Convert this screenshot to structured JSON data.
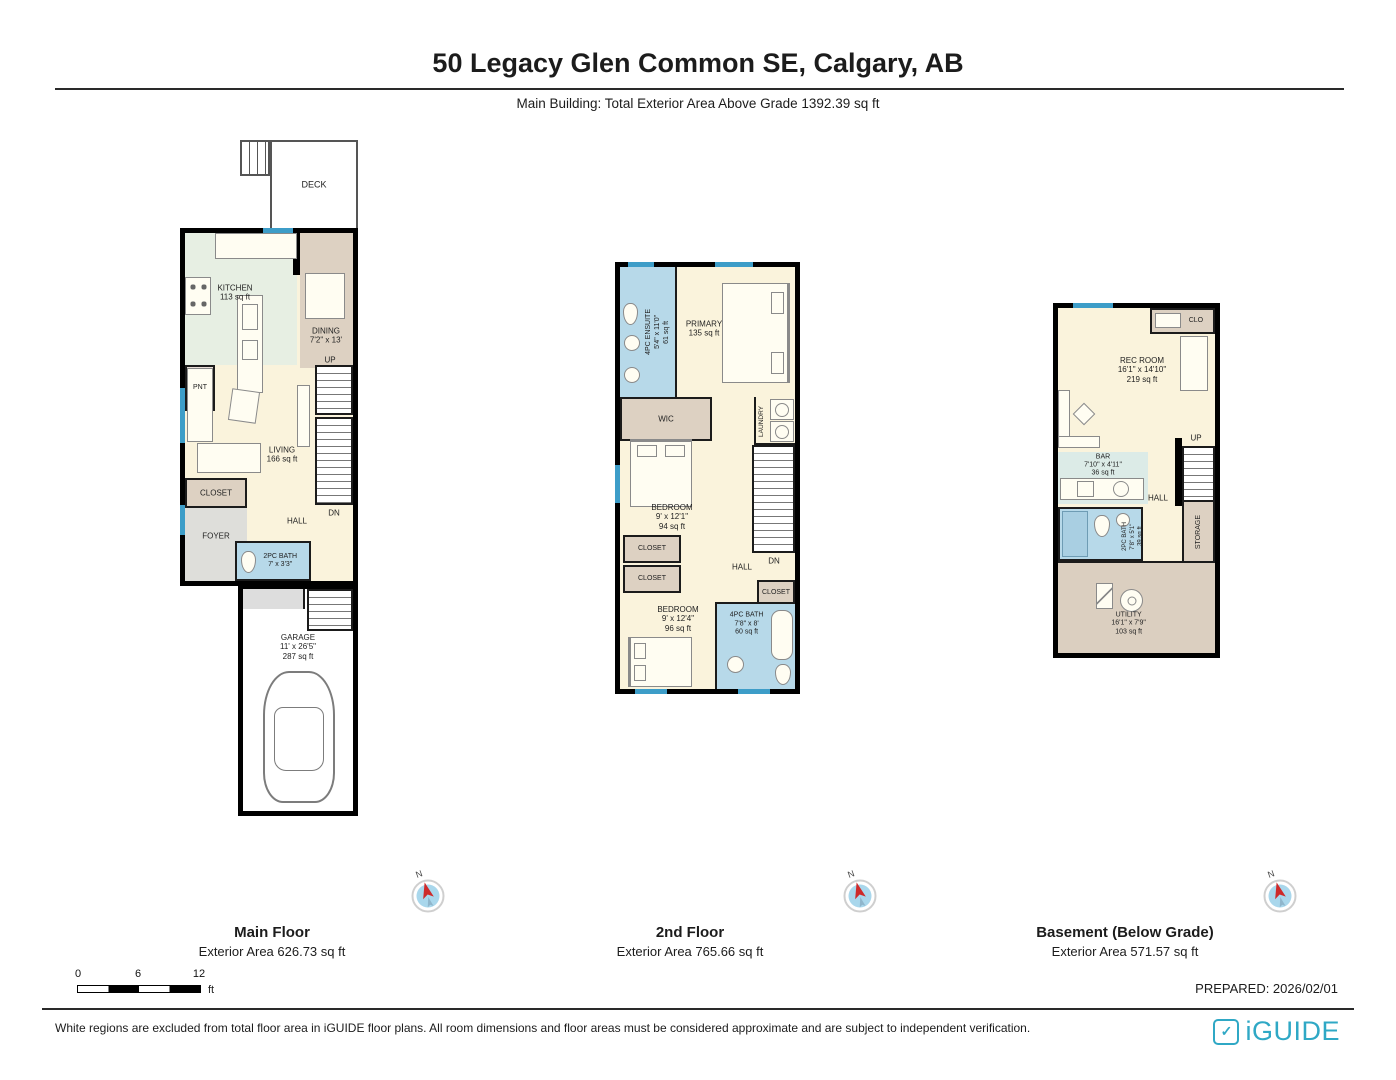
{
  "title": "50 Legacy Glen Common SE, Calgary, AB",
  "subtitle": "Main Building: Total Exterior Area Above Grade 1392.39 sq ft",
  "compass": {
    "n": "N"
  },
  "colors": {
    "brand_teal": "#2FA8C5",
    "window_blue": "#3D9DC8",
    "bath_blue": "#B7D9E9",
    "room_cream": "#FAF3DC",
    "room_tan": "#DBCFC0",
    "kitchen_green": "#E7EFE3",
    "compass_red": "#CE2A2A"
  },
  "floors": {
    "main": {
      "name": "Main Floor",
      "area": "Exterior Area 626.73 sq ft",
      "rooms": {
        "deck": {
          "label": "DECK"
        },
        "kitchen": {
          "label": "KITCHEN",
          "area": "113 sq ft"
        },
        "pantry": {
          "label": "PNT"
        },
        "dining": {
          "label": "DINING",
          "dims": "7'2\" x 13'"
        },
        "up": {
          "label": "UP"
        },
        "dn": {
          "label": "DN"
        },
        "living": {
          "label": "LIVING",
          "area": "166 sq ft"
        },
        "closet": {
          "label": "CLOSET"
        },
        "foyer": {
          "label": "FOYER"
        },
        "hall": {
          "label": "HALL"
        },
        "bath": {
          "label": "2PC BATH",
          "dims": "7' x 3'3\""
        },
        "garage": {
          "label": "GARAGE",
          "dims": "11' x 26'5\"",
          "area": "287 sq ft"
        }
      }
    },
    "second": {
      "name": "2nd Floor",
      "area": "Exterior Area 765.66 sq ft",
      "rooms": {
        "ensuite": {
          "label": "4PC ENSUITE",
          "dims": "5'4\" x 11'0\"",
          "area": "61 sq ft"
        },
        "primary": {
          "label": "PRIMARY",
          "area": "135 sq ft"
        },
        "wic": {
          "label": "WIC"
        },
        "laundry": {
          "label": "LAUNDRY"
        },
        "dn": {
          "label": "DN"
        },
        "bedroom1": {
          "label": "BEDROOM",
          "dims": "9' x 12'1\"",
          "area": "94 sq ft"
        },
        "closet1": {
          "label": "CLOSET"
        },
        "closet2": {
          "label": "CLOSET"
        },
        "closet3": {
          "label": "CLOSET"
        },
        "hall": {
          "label": "HALL"
        },
        "bedroom2": {
          "label": "BEDROOM",
          "dims": "9' x 12'4\"",
          "area": "96 sq ft"
        },
        "bath": {
          "label": "4PC BATH",
          "dims": "7'8\" x 8'",
          "area": "60 sq ft"
        }
      }
    },
    "basement": {
      "name": "Basement (Below Grade)",
      "area": "Exterior Area 571.57 sq ft",
      "rooms": {
        "clo": {
          "label": "CLO"
        },
        "rec": {
          "label": "REC ROOM",
          "dims": "16'1\" x 14'10\"",
          "area": "219 sq ft"
        },
        "up": {
          "label": "UP"
        },
        "bar": {
          "label": "BAR",
          "dims": "7'10\" x 4'11\"",
          "area": "36 sq ft"
        },
        "hall": {
          "label": "HALL"
        },
        "bath": {
          "label": "2PC BATH",
          "dims": "7'8\" x 5'1\"",
          "area": "39 sq ft"
        },
        "storage": {
          "label": "STORAGE"
        },
        "utility": {
          "label": "UTILITY",
          "dims": "16'1\" x 7'9\"",
          "area": "103 sq ft"
        }
      }
    }
  },
  "scale_bar": {
    "t0": "0",
    "t6": "6",
    "t12": "12",
    "unit": "ft"
  },
  "prepared": "PREPARED: 2026/02/01",
  "footer": {
    "disclaimer": "White regions are excluded from total floor area in iGUIDE floor plans. All room dimensions and floor areas must be considered approximate and are subject to independent verification.",
    "brand": "iGUIDE"
  }
}
